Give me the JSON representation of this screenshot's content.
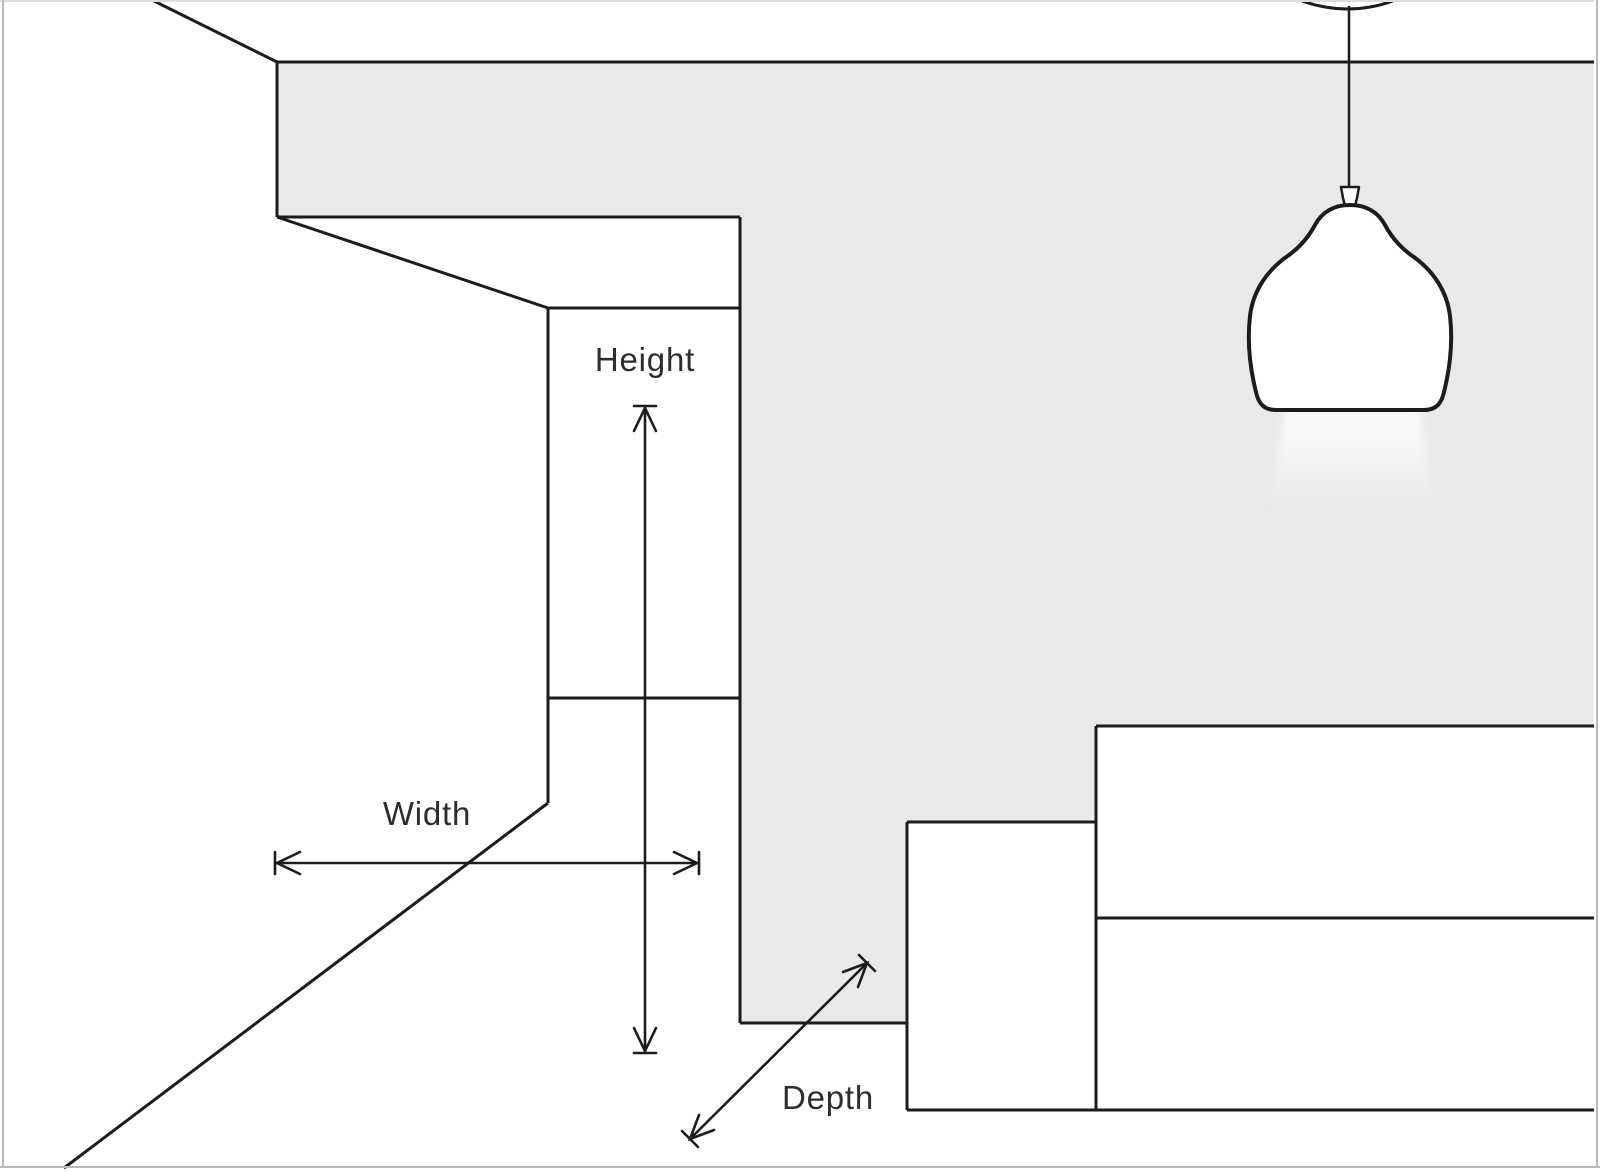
{
  "illustration": {
    "labels": {
      "height": "Height",
      "width": "Width",
      "depth": "Depth"
    }
  },
  "colors": {
    "background": "#ffffff",
    "wall": "#e9e9e9",
    "line": "#1c1c1c",
    "label-text": "#2d2d2d",
    "border": "#b9b9b9",
    "border-top": "#dddddd"
  }
}
